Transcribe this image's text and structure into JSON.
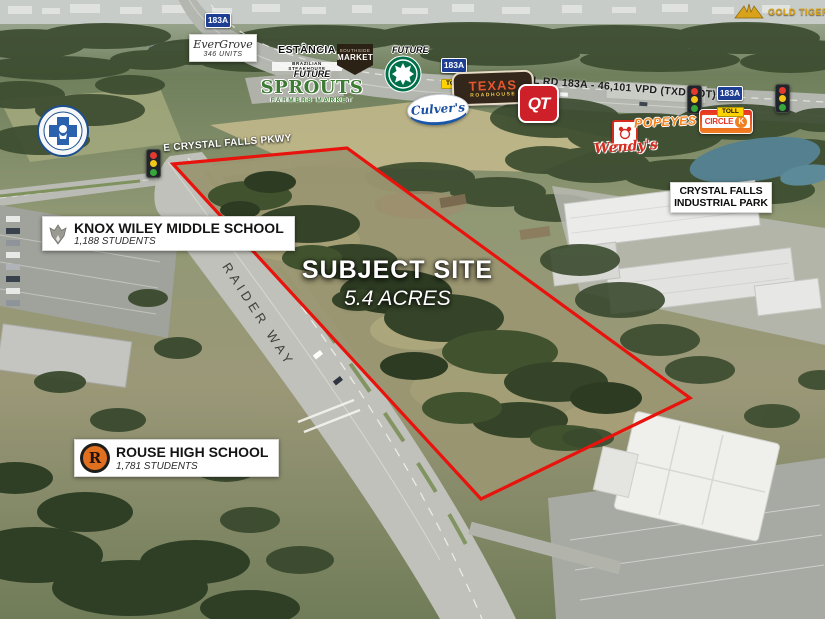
{
  "watermark": {
    "text": "GOLD TIGER"
  },
  "subject_site": {
    "title": "SUBJECT SITE",
    "acres": "5.4 ACRES"
  },
  "roads": {
    "parkway": "E CRYSTAL FALLS PKWY",
    "raider_way": "RAIDER WAY",
    "toll_caption": "TOLL RD 183A - 46,101 VPD (TXD DOT)"
  },
  "toll_shield": {
    "route": "183A",
    "tag": "TOLL"
  },
  "schools": {
    "knox_wiley": {
      "name": "KNOX WILEY MIDDLE SCHOOL",
      "students": "1,188 STUDENTS"
    },
    "rouse": {
      "name": "ROUSE HIGH SCHOOL",
      "students": "1,781 STUDENTS",
      "monogram": "R"
    }
  },
  "places": {
    "evergrove": {
      "name": "EverGrove",
      "units": "346 UNITS"
    },
    "estancia": {
      "name": "ESTÂNCIA",
      "tagline": "BRAZILIAN STEAKHOUSE"
    },
    "southside_market": {
      "line1": "SOUTHSIDE",
      "line2": "MARKET"
    },
    "starbucks": {
      "future": "FUTURE"
    },
    "sprouts": {
      "future": "FUTURE",
      "name": "SPROUTS",
      "tagline": "FARMERS MARKET"
    },
    "texas_roadhouse": {
      "line1": "TEXAS",
      "line2": "ROADHOUSE"
    },
    "culvers": {
      "name": "Culver's"
    },
    "qt": {
      "name": "QT"
    },
    "wendys": {
      "name": "Wendy's"
    },
    "popeyes": {
      "name": "POPEYES"
    },
    "circle_k": {
      "word": "CIRCLE",
      "k": "K"
    },
    "industrial_park": {
      "line1": "CRYSTAL FALLS",
      "line2": "INDUSTRIAL PARK"
    }
  },
  "colors": {
    "boundary_red": "#E8130C",
    "starbucks_green": "#00704A",
    "sprouts_green": "#3E7B34",
    "popeyes_orange": "#F6841F",
    "qt_red": "#CE2029",
    "circle_k_red": "#ED1C24",
    "shield_blue": "#1E3E93",
    "toll_yellow": "#FFD200",
    "watermark_gold": "#D8A31A"
  }
}
